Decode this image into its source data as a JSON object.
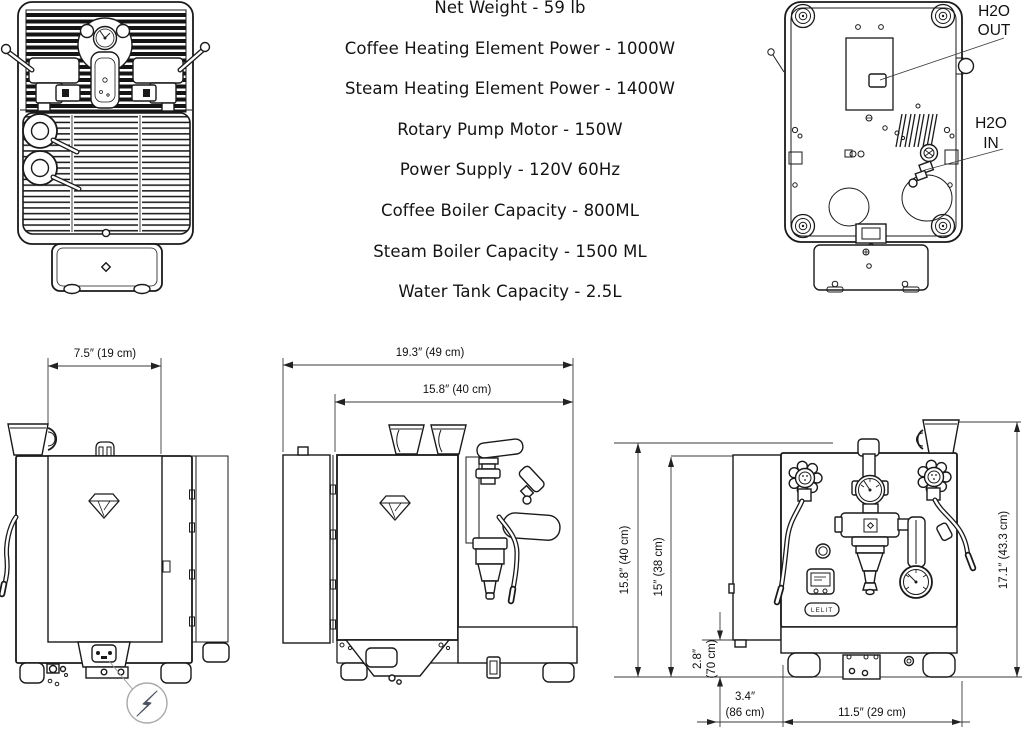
{
  "specs": {
    "lines": [
      "Net Weight - 59 lb",
      "Coffee Heating Element Power - 1000W",
      "Steam Heating Element Power - 1400W",
      "Rotary Pump Motor - 150W",
      "Power Supply - 120V 60Hz",
      "Coffee Boiler Capacity - 800ML",
      "Steam Boiler Capacity - 1500 ML",
      "Water Tank Capacity - 2.5L"
    ]
  },
  "callouts": {
    "h2o_out_line1": "H2O",
    "h2o_out_line2": "OUT",
    "h2o_in_line1": "H2O",
    "h2o_in_line2": "IN"
  },
  "dimensions": {
    "back_width": "7.5″ (19 cm)",
    "depth_total": "19.3″ (49 cm)",
    "depth_body": "15.8″ (40 cm)",
    "height_total": "15.8″ (40 cm)",
    "height_body": "15″ (38 cm)",
    "base_height_in": "2.8″",
    "base_height_cm": "(70 cm)",
    "rear_depth_in": "3.4″",
    "rear_depth_cm": "(86 cm)",
    "front_width": "11.5″ (29 cm)",
    "height_with_cup": "17.1″ (43.3 cm)"
  },
  "brand": {
    "logo": "LELIT"
  },
  "colors": {
    "line": "#1a1a1a",
    "dim_line": "#3a3a3a",
    "bolt": "#4a5261",
    "bolt_circle": "#aaaaaa"
  }
}
